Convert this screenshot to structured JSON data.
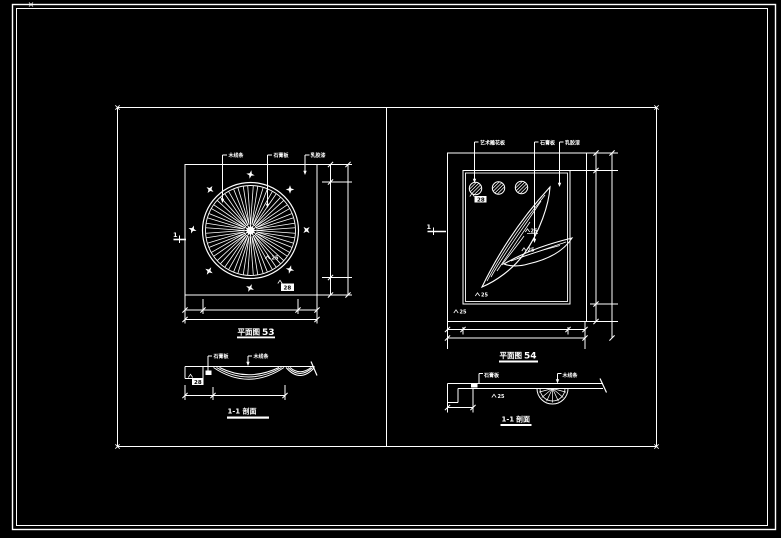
{
  "colors": {
    "background": "#000000",
    "line": "#ffffff"
  },
  "left_plan": {
    "callouts": [
      "木线条",
      "石膏板",
      "乳胶漆"
    ],
    "section_marker": "1",
    "detail_note": "25",
    "corner_tag": "28",
    "title": "平面图",
    "drawing_number": "53"
  },
  "left_section": {
    "callouts": [
      "石膏板",
      "木线条"
    ],
    "corner_tag": "28",
    "title": "1-1",
    "title_suffix": "剖面"
  },
  "right_plan": {
    "callouts": [
      "艺术雕花板",
      "石膏板",
      "乳胶漆"
    ],
    "section_marker": "1",
    "corner_tag": "28",
    "notes": [
      "25",
      "25",
      "25",
      "25"
    ],
    "title": "平面图",
    "drawing_number": "54"
  },
  "right_section": {
    "callouts": [
      "石膏板",
      "木线条"
    ],
    "detail_note": "25",
    "title": "1-1",
    "title_suffix": "剖面"
  }
}
